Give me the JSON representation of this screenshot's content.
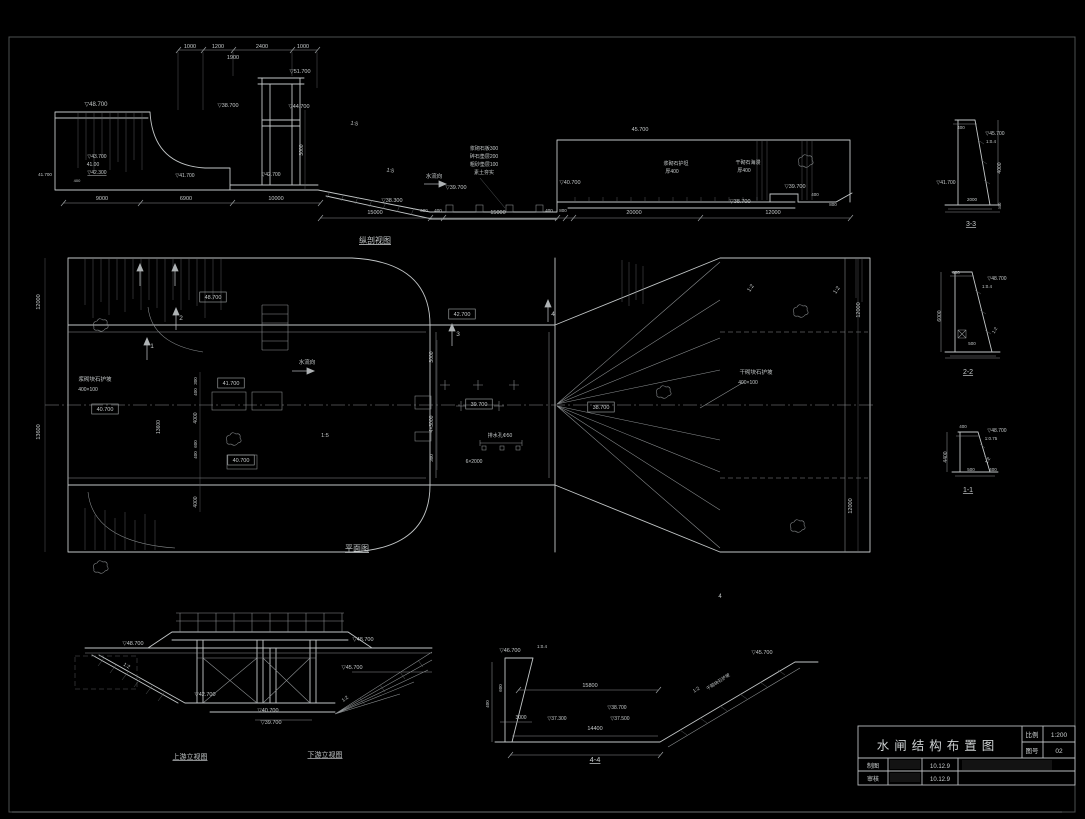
{
  "sheet": {
    "bg": "#000000",
    "frame_color": "#4c5051",
    "line_color": "#c2c6c7",
    "dim_line_color": "#8e9294",
    "scale": "1:200"
  },
  "title_block": {
    "title": "水闸结构布置图",
    "scale_label": "比例",
    "scale_value": "1:200",
    "number_label": "图号",
    "number_value": "02",
    "drafter_label": "制图",
    "drafter_date": "10.12.9",
    "checker_label": "审核",
    "checker_date": "10.12.9"
  },
  "long_section": {
    "labels": [
      {
        "x": 190,
        "y": 48,
        "t": "1000",
        "s": 5.5
      },
      {
        "x": 218,
        "y": 48,
        "t": "1200",
        "s": 5.5
      },
      {
        "x": 262,
        "y": 48,
        "t": "2400",
        "s": 5.5
      },
      {
        "x": 303,
        "y": 48,
        "t": "1000",
        "s": 5.5
      },
      {
        "x": 233,
        "y": 59,
        "t": "1900",
        "s": 5.5
      },
      {
        "x": 300,
        "y": 73,
        "t": "▽51.700",
        "s": 5.5
      },
      {
        "x": 96,
        "y": 106,
        "t": "▽48.700",
        "s": 6
      },
      {
        "x": 228,
        "y": 107,
        "t": "▽38.700",
        "s": 5.5
      },
      {
        "x": 299,
        "y": 108,
        "t": "▽44.700",
        "s": 5.5
      },
      {
        "x": 97,
        "y": 158,
        "t": "▽43.700",
        "s": 5
      },
      {
        "x": 93,
        "y": 166,
        "t": "41.00",
        "s": 5
      },
      {
        "x": 97,
        "y": 174,
        "t": "▽42.300",
        "s": 5,
        "u": true
      },
      {
        "x": 45,
        "y": 176,
        "t": "41.700",
        "s": 4.5
      },
      {
        "x": 77,
        "y": 182,
        "t": "400",
        "s": 4
      },
      {
        "x": 185,
        "y": 177,
        "t": "▽41.700",
        "s": 5
      },
      {
        "x": 271,
        "y": 176,
        "t": "▽42.700",
        "s": 5
      },
      {
        "x": 102,
        "y": 200,
        "t": "9000",
        "s": 5.5
      },
      {
        "x": 186,
        "y": 200,
        "t": "6900",
        "s": 5.5
      },
      {
        "x": 276,
        "y": 200,
        "t": "10000",
        "s": 5.5
      },
      {
        "x": 303,
        "y": 150,
        "t": "3000",
        "s": 5,
        "r": -90
      },
      {
        "x": 354,
        "y": 125,
        "t": "1:5",
        "s": 5.5,
        "r": 12
      },
      {
        "x": 390,
        "y": 172,
        "t": "1:5",
        "s": 5.5,
        "r": 12
      },
      {
        "x": 434,
        "y": 178,
        "t": "水流向",
        "s": 5.5
      },
      {
        "x": 484,
        "y": 150,
        "t": "浆砌石板300",
        "s": 5
      },
      {
        "x": 484,
        "y": 158,
        "t": "碎石垫层200",
        "s": 5
      },
      {
        "x": 484,
        "y": 166,
        "t": "粗砂垫层100",
        "s": 5
      },
      {
        "x": 484,
        "y": 174,
        "t": "素土夯实",
        "s": 5
      },
      {
        "x": 392,
        "y": 202,
        "t": "▽38.300",
        "s": 5.5
      },
      {
        "x": 456,
        "y": 189,
        "t": "▽39.700",
        "s": 5.5
      },
      {
        "x": 570,
        "y": 184,
        "t": "▽40.700",
        "s": 5.5
      },
      {
        "x": 640,
        "y": 131,
        "t": "45.700",
        "s": 5.5
      },
      {
        "x": 676,
        "y": 165,
        "t": "浆砌石护坦",
        "s": 5
      },
      {
        "x": 672,
        "y": 173,
        "t": "厚400",
        "s": 5
      },
      {
        "x": 748,
        "y": 164,
        "t": "干砌石海漫",
        "s": 5
      },
      {
        "x": 744,
        "y": 172,
        "t": "厚400",
        "s": 5
      },
      {
        "x": 795,
        "y": 188,
        "t": "▽39.700",
        "s": 5.5
      },
      {
        "x": 740,
        "y": 203,
        "t": "▽38.700",
        "s": 5.5
      },
      {
        "x": 815,
        "y": 196,
        "t": "400",
        "s": 4.5
      },
      {
        "x": 833,
        "y": 206,
        "t": "800",
        "s": 4.5
      },
      {
        "x": 375,
        "y": 214,
        "t": "15000",
        "s": 5.5
      },
      {
        "x": 424,
        "y": 212,
        "t": "600",
        "s": 4.5
      },
      {
        "x": 438,
        "y": 212,
        "t": "400",
        "s": 4.5
      },
      {
        "x": 498,
        "y": 214,
        "t": "15000",
        "s": 5.5
      },
      {
        "x": 549,
        "y": 212,
        "t": "400",
        "s": 4.5
      },
      {
        "x": 563,
        "y": 212,
        "t": "800",
        "s": 4.5
      },
      {
        "x": 634,
        "y": 214,
        "t": "20000",
        "s": 5.5
      },
      {
        "x": 773,
        "y": 214,
        "t": "12000",
        "s": 5.5
      },
      {
        "x": 375,
        "y": 243,
        "t": "纵剖视图",
        "s": 8,
        "u": true,
        "n": "view-title"
      }
    ]
  },
  "plan": {
    "labels": [
      {
        "x": 40,
        "y": 302,
        "t": "12000",
        "s": 5.5,
        "r": -90
      },
      {
        "x": 40,
        "y": 432,
        "t": "13600",
        "s": 5.5,
        "r": -90
      },
      {
        "x": 160,
        "y": 427,
        "t": "13600",
        "s": 5,
        "r": -90
      },
      {
        "x": 213,
        "y": 299,
        "t": "48.700",
        "s": 5.5,
        "b": true
      },
      {
        "x": 95,
        "y": 381,
        "t": "浆砌块石护坡",
        "s": 5.5
      },
      {
        "x": 88,
        "y": 391,
        "t": "400×100",
        "s": 5
      },
      {
        "x": 105,
        "y": 411,
        "t": "40.700",
        "s": 5.5,
        "b": true
      },
      {
        "x": 231,
        "y": 385,
        "t": "41.700",
        "s": 5.5,
        "b": true
      },
      {
        "x": 241,
        "y": 462,
        "t": "40.700",
        "s": 5.5,
        "b": true
      },
      {
        "x": 462,
        "y": 316,
        "t": "42.700",
        "s": 5.5,
        "b": true
      },
      {
        "x": 479,
        "y": 406,
        "t": "39.700",
        "s": 5.5,
        "b": true
      },
      {
        "x": 601,
        "y": 409,
        "t": "38.700",
        "s": 5.5,
        "b": true
      },
      {
        "x": 307,
        "y": 364,
        "t": "水流向",
        "s": 5.5
      },
      {
        "x": 325,
        "y": 437,
        "t": "1:5",
        "s": 5.5
      },
      {
        "x": 500,
        "y": 437,
        "t": "排水孔Φ50",
        "s": 5
      },
      {
        "x": 474,
        "y": 463,
        "t": "6×2000",
        "s": 5
      },
      {
        "x": 433,
        "y": 357,
        "t": "3000",
        "s": 5,
        "r": -90
      },
      {
        "x": 433,
        "y": 424,
        "t": "4×3000",
        "s": 5,
        "r": -90
      },
      {
        "x": 433,
        "y": 458,
        "t": "300",
        "s": 4.5,
        "r": -90
      },
      {
        "x": 197,
        "y": 381,
        "t": "300",
        "s": 4.5,
        "r": -90
      },
      {
        "x": 197,
        "y": 392,
        "t": "400",
        "s": 4.5,
        "r": -90
      },
      {
        "x": 197,
        "y": 418,
        "t": "4000",
        "s": 5,
        "r": -90
      },
      {
        "x": 197,
        "y": 444,
        "t": "600",
        "s": 4.5,
        "r": -90
      },
      {
        "x": 197,
        "y": 455,
        "t": "400",
        "s": 4.5,
        "r": -90
      },
      {
        "x": 197,
        "y": 502,
        "t": "4000",
        "s": 5,
        "r": -90
      },
      {
        "x": 756,
        "y": 374,
        "t": "干砌块石护坡",
        "s": 5.5
      },
      {
        "x": 748,
        "y": 384,
        "t": "400×100",
        "s": 5
      },
      {
        "x": 752,
        "y": 289,
        "t": "1:2",
        "s": 5.5,
        "r": -55
      },
      {
        "x": 838,
        "y": 291,
        "t": "1:2",
        "s": 5.5,
        "r": -55
      },
      {
        "x": 860,
        "y": 310,
        "t": "12000",
        "s": 5.5,
        "r": -90
      },
      {
        "x": 852,
        "y": 506,
        "t": "12000",
        "s": 5.5,
        "r": -90
      },
      {
        "x": 181,
        "y": 320,
        "t": "2",
        "s": 6.5
      },
      {
        "x": 152,
        "y": 348,
        "t": "1",
        "s": 6.5
      },
      {
        "x": 458,
        "y": 336,
        "t": "3",
        "s": 6.5
      },
      {
        "x": 553,
        "y": 316,
        "t": "4",
        "s": 6.5
      },
      {
        "x": 720,
        "y": 598,
        "t": "4",
        "s": 6
      },
      {
        "x": 357,
        "y": 551,
        "t": "平面图",
        "s": 8,
        "u": true,
        "n": "view-title"
      }
    ]
  },
  "elevations": {
    "labels": [
      {
        "x": 133,
        "y": 645,
        "t": "▽48.700",
        "s": 5.5
      },
      {
        "x": 363,
        "y": 641,
        "t": "▽48.700",
        "s": 5.5
      },
      {
        "x": 352,
        "y": 669,
        "t": "▽45.700",
        "s": 5.5
      },
      {
        "x": 205,
        "y": 696,
        "t": "▽42.700",
        "s": 5.5
      },
      {
        "x": 268,
        "y": 712,
        "t": "▽40.700",
        "s": 5.5
      },
      {
        "x": 271,
        "y": 724,
        "t": "▽39.700",
        "s": 5.5
      },
      {
        "x": 126,
        "y": 667,
        "t": "1:2",
        "s": 5,
        "r": 30
      },
      {
        "x": 346,
        "y": 700,
        "t": "1:2",
        "s": 5,
        "r": -38
      },
      {
        "x": 190,
        "y": 759,
        "t": "上游立视图",
        "s": 7,
        "u": true,
        "n": "view-title"
      },
      {
        "x": 325,
        "y": 757,
        "t": "下游立视图",
        "s": 7,
        "u": true,
        "n": "view-title"
      }
    ]
  },
  "section_44": {
    "labels": [
      {
        "x": 510,
        "y": 652,
        "t": "▽46.700",
        "s": 5.5
      },
      {
        "x": 542,
        "y": 648,
        "t": "1:0.4",
        "s": 4.5
      },
      {
        "x": 502,
        "y": 688,
        "t": "600",
        "s": 4.5,
        "r": -90
      },
      {
        "x": 489,
        "y": 704,
        "t": "400",
        "s": 4.5,
        "r": -90
      },
      {
        "x": 521,
        "y": 719,
        "t": "3000",
        "s": 5
      },
      {
        "x": 590,
        "y": 687,
        "t": "15800",
        "s": 5.5
      },
      {
        "x": 557,
        "y": 720,
        "t": "▽37.300",
        "s": 5
      },
      {
        "x": 617,
        "y": 709,
        "t": "▽38.700",
        "s": 5
      },
      {
        "x": 620,
        "y": 720,
        "t": "▽37.500",
        "s": 5
      },
      {
        "x": 595,
        "y": 730,
        "t": "14400",
        "s": 5.5
      },
      {
        "x": 697,
        "y": 691,
        "t": "1:2",
        "s": 5,
        "r": -33
      },
      {
        "x": 719,
        "y": 683,
        "t": "干砌块石护坡",
        "s": 4.5,
        "r": -33
      },
      {
        "x": 762,
        "y": 654,
        "t": "▽45.700",
        "s": 5.5
      },
      {
        "x": 595,
        "y": 762,
        "t": "4-4",
        "s": 7.5,
        "u": true,
        "n": "view-title"
      }
    ]
  },
  "section_33": {
    "labels": [
      {
        "x": 961,
        "y": 129,
        "t": "400",
        "s": 4.5
      },
      {
        "x": 995,
        "y": 135,
        "t": "▽45.700",
        "s": 5
      },
      {
        "x": 991,
        "y": 143,
        "t": "1:0.4",
        "s": 4.5
      },
      {
        "x": 1001,
        "y": 168,
        "t": "4000",
        "s": 5,
        "r": -90
      },
      {
        "x": 946,
        "y": 184,
        "t": "▽41.700",
        "s": 5
      },
      {
        "x": 972,
        "y": 201,
        "t": "2000",
        "s": 4.5
      },
      {
        "x": 1001,
        "y": 206,
        "t": "300",
        "s": 4,
        "r": -90
      },
      {
        "x": 971,
        "y": 226,
        "t": "3-3",
        "s": 7,
        "u": true,
        "n": "view-title"
      }
    ]
  },
  "section_22": {
    "labels": [
      {
        "x": 956,
        "y": 274,
        "t": "400",
        "s": 4.5
      },
      {
        "x": 997,
        "y": 280,
        "t": "▽48.700",
        "s": 5
      },
      {
        "x": 987,
        "y": 288,
        "t": "1:0.4",
        "s": 4.5
      },
      {
        "x": 941,
        "y": 316,
        "t": "6000",
        "s": 5,
        "r": -90
      },
      {
        "x": 996,
        "y": 331,
        "t": "1:2",
        "s": 4.5,
        "r": -60
      },
      {
        "x": 972,
        "y": 345,
        "t": "500",
        "s": 4.5
      },
      {
        "x": 968,
        "y": 374,
        "t": "2-2",
        "s": 7,
        "u": true,
        "n": "view-title"
      }
    ]
  },
  "section_11": {
    "labels": [
      {
        "x": 963,
        "y": 428,
        "t": "400",
        "s": 4.5
      },
      {
        "x": 997,
        "y": 432,
        "t": "▽48.700",
        "s": 5
      },
      {
        "x": 991,
        "y": 440,
        "t": "1:0.75",
        "s": 4.5
      },
      {
        "x": 947,
        "y": 457,
        "t": "4400",
        "s": 5,
        "r": -90
      },
      {
        "x": 989,
        "y": 461,
        "t": "1:2",
        "s": 4.5,
        "r": -60
      },
      {
        "x": 971,
        "y": 471,
        "t": "500",
        "s": 4.5
      },
      {
        "x": 993,
        "y": 471,
        "t": "400",
        "s": 4.5
      },
      {
        "x": 968,
        "y": 492,
        "t": "1-1",
        "s": 7,
        "u": true,
        "n": "view-title"
      }
    ]
  }
}
